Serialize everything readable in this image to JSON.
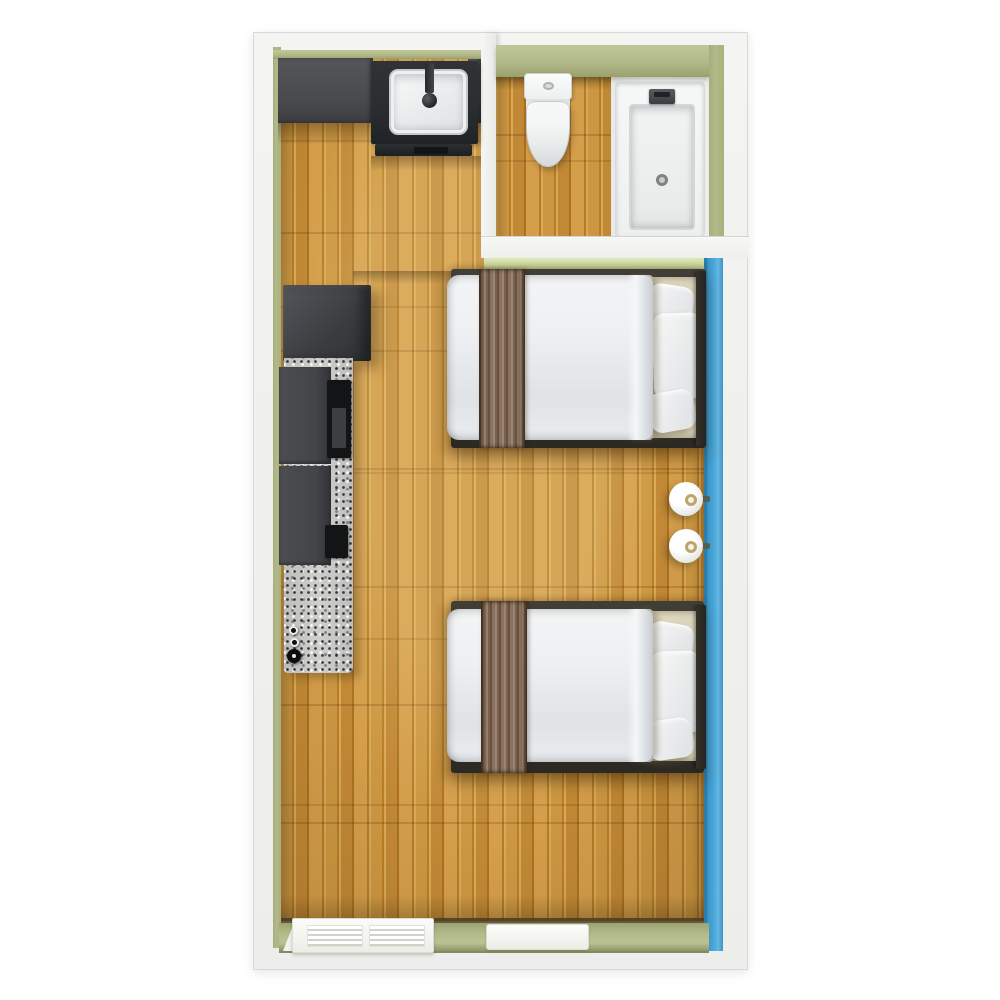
{
  "scene": {
    "type": "floor-plan-rendering",
    "view": "top-down 3D",
    "rooms": [
      {
        "name": "main-room",
        "features": [
          "kitchenette",
          "wood-floor",
          "two-double-beds",
          "wall-lamps",
          "louvered-panel",
          "floor-mat"
        ]
      },
      {
        "name": "bathroom",
        "features": [
          "toilet",
          "bathtub",
          "wood-floor"
        ]
      }
    ],
    "fixtures": [
      "upper-cabinet",
      "sink-vanity",
      "vanity-faucet",
      "refrigerator",
      "granite-counter",
      "base-cabinets",
      "cooktop",
      "stove-knobs",
      "toilet",
      "bathtub",
      "tub-faucet",
      "tub-drain",
      "bed-1",
      "bed-2",
      "duvet",
      "runner-throw",
      "pillows",
      "headboard",
      "wall-lamp-1",
      "wall-lamp-2",
      "louvered-panel",
      "floor-mat"
    ]
  },
  "colors": {
    "page_bg": "#ffffff",
    "wall_face": "#f1f1ef",
    "wall_border": "#d9d9d6",
    "wall_green": "#b2b989",
    "wall_green_light": "#cdd9a0",
    "wall_blue": "#45a3d6",
    "wall_blue_dark": "#2b7fae",
    "floor_edge_dark": "#4a3c20",
    "wood_light": "#d8a958",
    "wood_mid": "#c99440",
    "wood_dark": "#aa721f",
    "granite": "#c9c9c7",
    "cabinet_gray": "#47494c",
    "cabinet_gray_light": "#54565a",
    "vanity_dark": "#2a2d30",
    "appliance_black": "#131416",
    "bed_duvet": "#eef0f2",
    "bed_duvet_shade": "#dfe3e6",
    "bed_frame": "#38352e",
    "runner_brown": "#8a7160",
    "runner_brown_dark": "#66513f",
    "runner_brown_light": "#9b8470",
    "sheet_beige": "#e0dac2",
    "pillow_white": "#f8f8f7",
    "lamp_ring_gold": "#bfa468",
    "lamp_bracket": "#55614d"
  }
}
